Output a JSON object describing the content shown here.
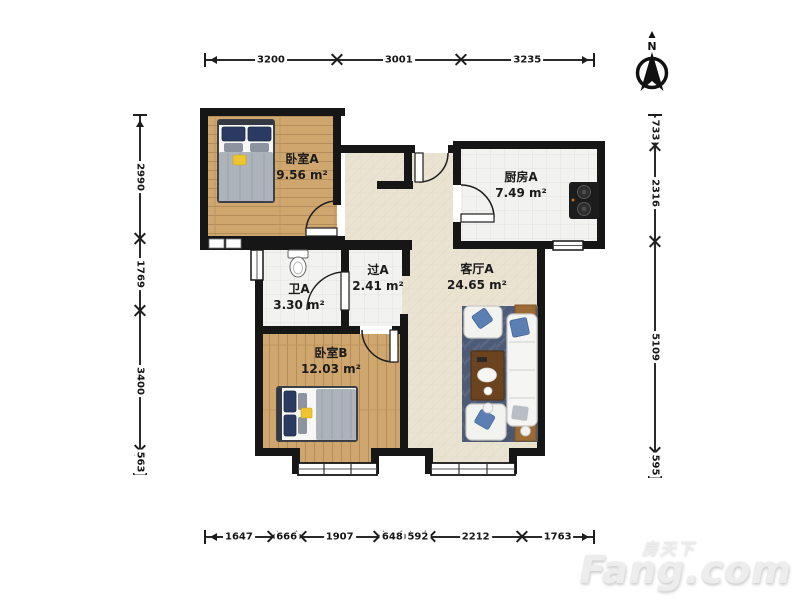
{
  "rooms": [
    {
      "id": "bedroom-a",
      "name": "卧室A",
      "area": "9.56 m²"
    },
    {
      "id": "kitchen-a",
      "name": "厨房A",
      "area": "7.49 m²"
    },
    {
      "id": "hall-a",
      "name": "过A",
      "area": "2.41 m²"
    },
    {
      "id": "bath-a",
      "name": "卫A",
      "area": "3.30 m²"
    },
    {
      "id": "living-a",
      "name": "客厅A",
      "area": "24.65 m²"
    },
    {
      "id": "bedroom-b",
      "name": "卧室B",
      "area": "12.03 m²"
    }
  ],
  "dimensions_mm": {
    "top": [
      3200,
      3001,
      3235
    ],
    "bottom": [
      1647,
      666,
      1907,
      648,
      592,
      2212,
      1763
    ],
    "left": [
      2990,
      1769,
      3400,
      563
    ],
    "right": [
      733,
      2316,
      5109,
      595
    ]
  },
  "compass": {
    "label": "N"
  },
  "watermark": {
    "line1": "房天下",
    "line2": "Fang.com"
  },
  "colors": {
    "wall": "#161616",
    "wood_floor": "#cfa76e",
    "tile_floor": "#f2f2f0",
    "beige_floor": "#eae3d2",
    "rug": "#4e5b76",
    "pillow_navy": "#2b3a60",
    "pillow_blue": "#5b7fb3",
    "accent_yellow": "#edc52e",
    "stove": "#1c1c1c",
    "watermark_gray": "#ededed"
  }
}
